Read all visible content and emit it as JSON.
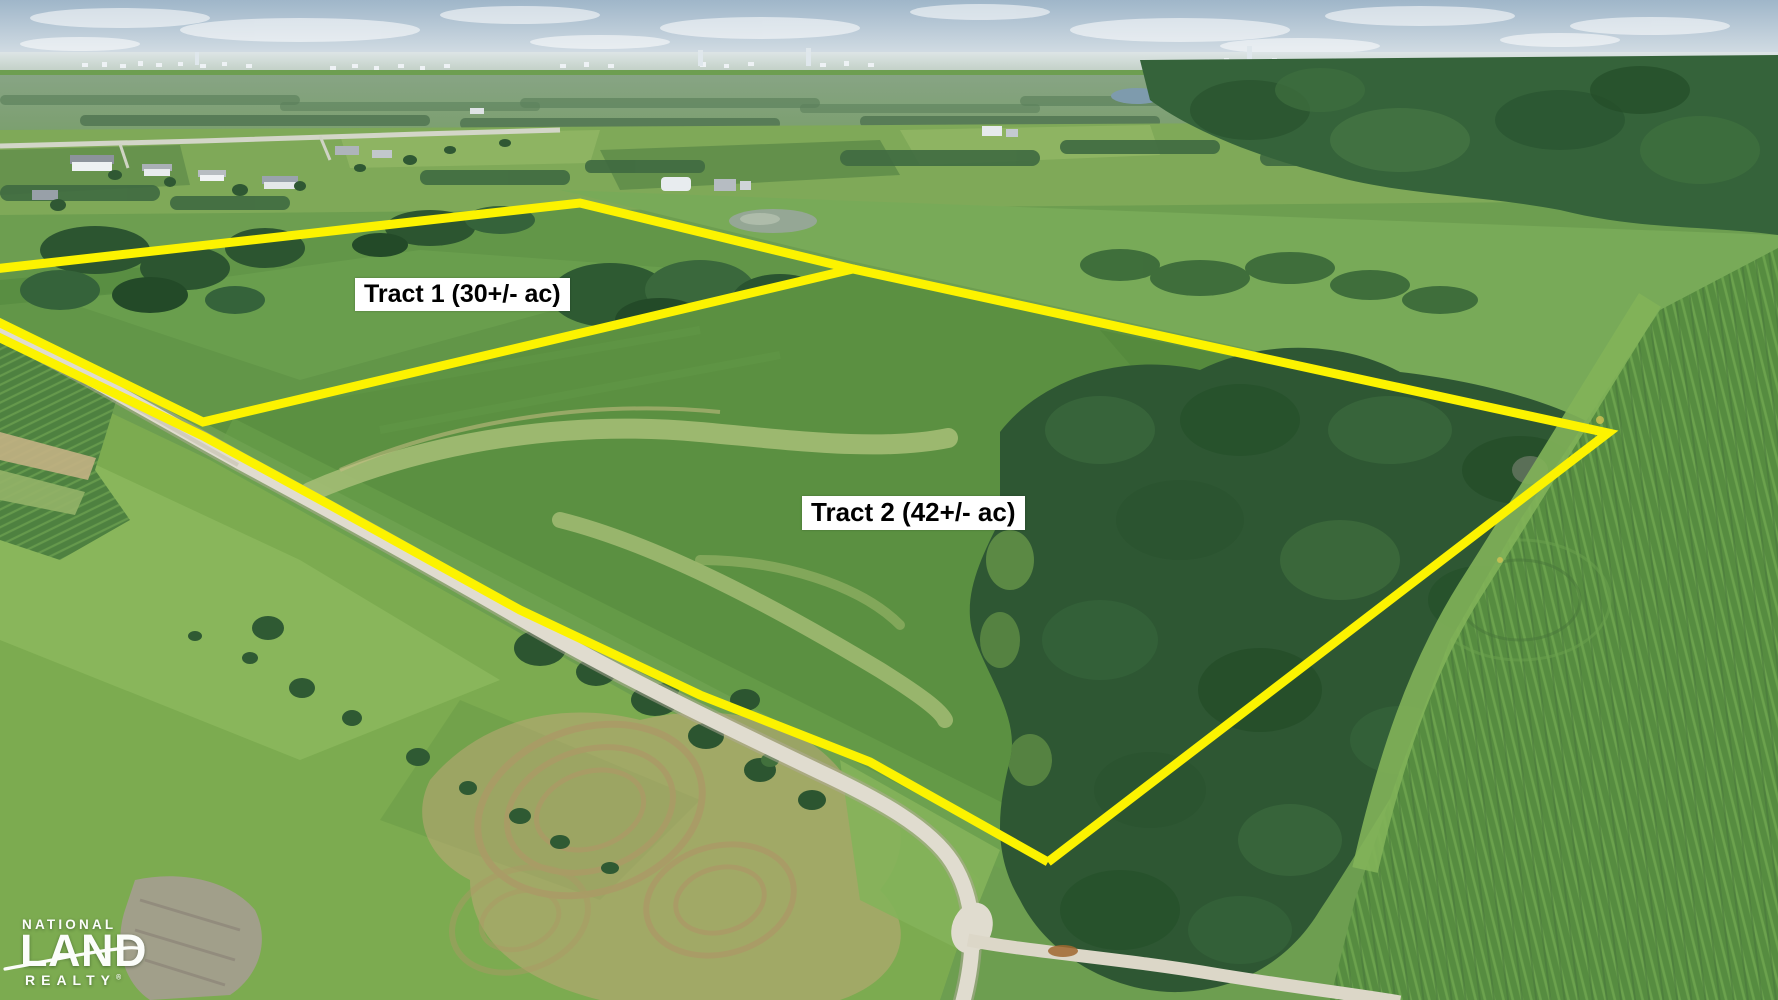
{
  "labels": {
    "tract1": "Tract 1 (30+/- ac)",
    "tract2": "Tract 2 (42+/- ac)"
  },
  "logo": {
    "top": "NATIONAL",
    "middle": "LAND",
    "bottom": "REALTY",
    "mark": "®"
  },
  "colors": {
    "boundary_yellow": "#FCF300",
    "label_background": "#FFFFFF",
    "label_text": "#000000",
    "logo_text": "#FBFDFA",
    "sky": "#A3B8CA",
    "pasture_green": "#5E9344",
    "forest_green": "#2E5733",
    "gravel_road": "#E0DCCF",
    "mow_tan": "#C0A878"
  }
}
